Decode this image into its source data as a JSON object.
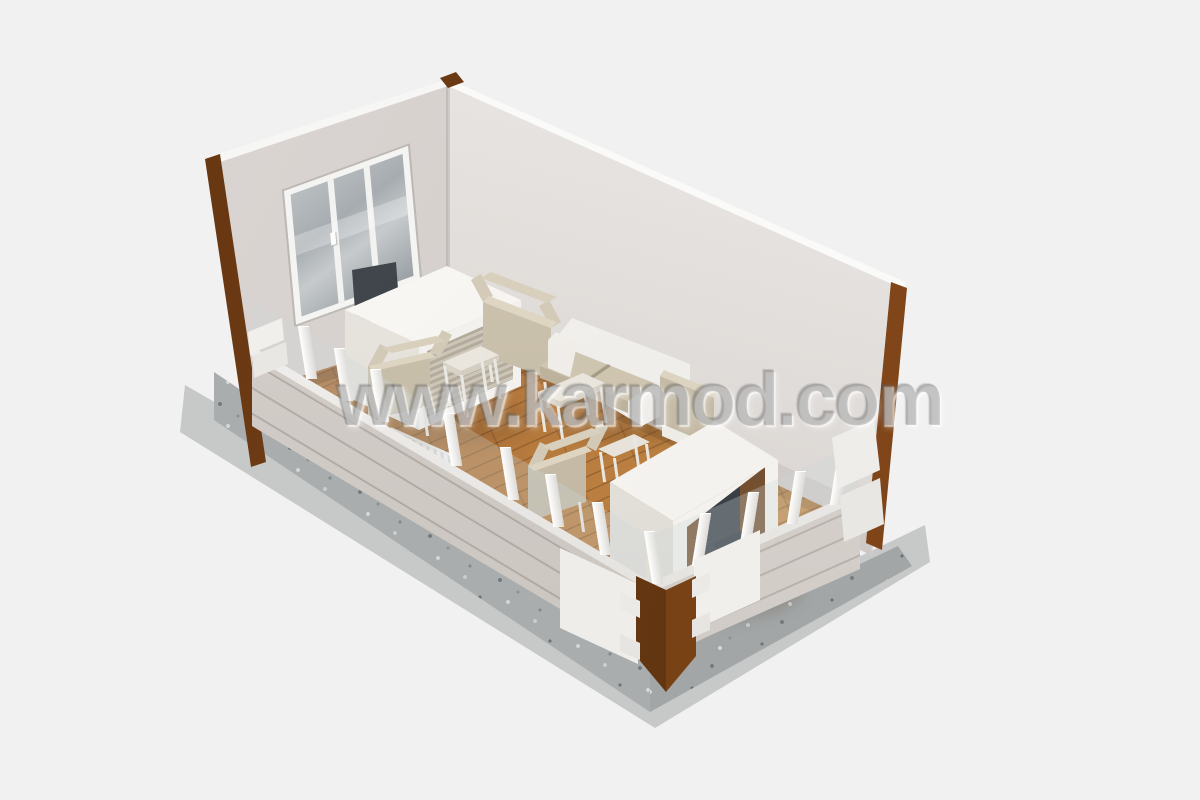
{
  "watermark": {
    "text": "www.karmod.com"
  },
  "scene": {
    "description": "Isometric 3D cutaway rendering of a prefabricated container office interior",
    "room": {
      "walls": "light grey sandwich panels with white top cap",
      "floor": "wooden laminate planks",
      "base": "speckled gravel concrete strip",
      "frame": "dark brown corner posts",
      "front_walls": "cut away low walls with white studs and glass"
    },
    "furniture": [
      "triple-pane window",
      "executive desk with ribbed front panel",
      "dark office chair",
      "two beige guest armchairs with square side table",
      "white two-seat sofa with beige cushions",
      "beige armchair",
      "coffee table",
      "second white desk with dark office chair",
      "guest armchair with side table",
      "white panel radiator"
    ]
  },
  "colors": {
    "background": "#f1f1f2",
    "wall": "#d6d1ce",
    "wall-light": "#eceae8",
    "wall-cap": "#f7f7f6",
    "wood-floor": "#b5783c",
    "wood-dark": "#8a5526",
    "brown-frame": "#73411a",
    "brown-dark": "#58300f",
    "gravel": "#a9adae",
    "white-furniture": "#f3f1ed",
    "cushion": "#cfc5b0",
    "dark-chair": "#3e444a",
    "glass": "#aeb3b6",
    "radiator": "#f2f2f0"
  }
}
